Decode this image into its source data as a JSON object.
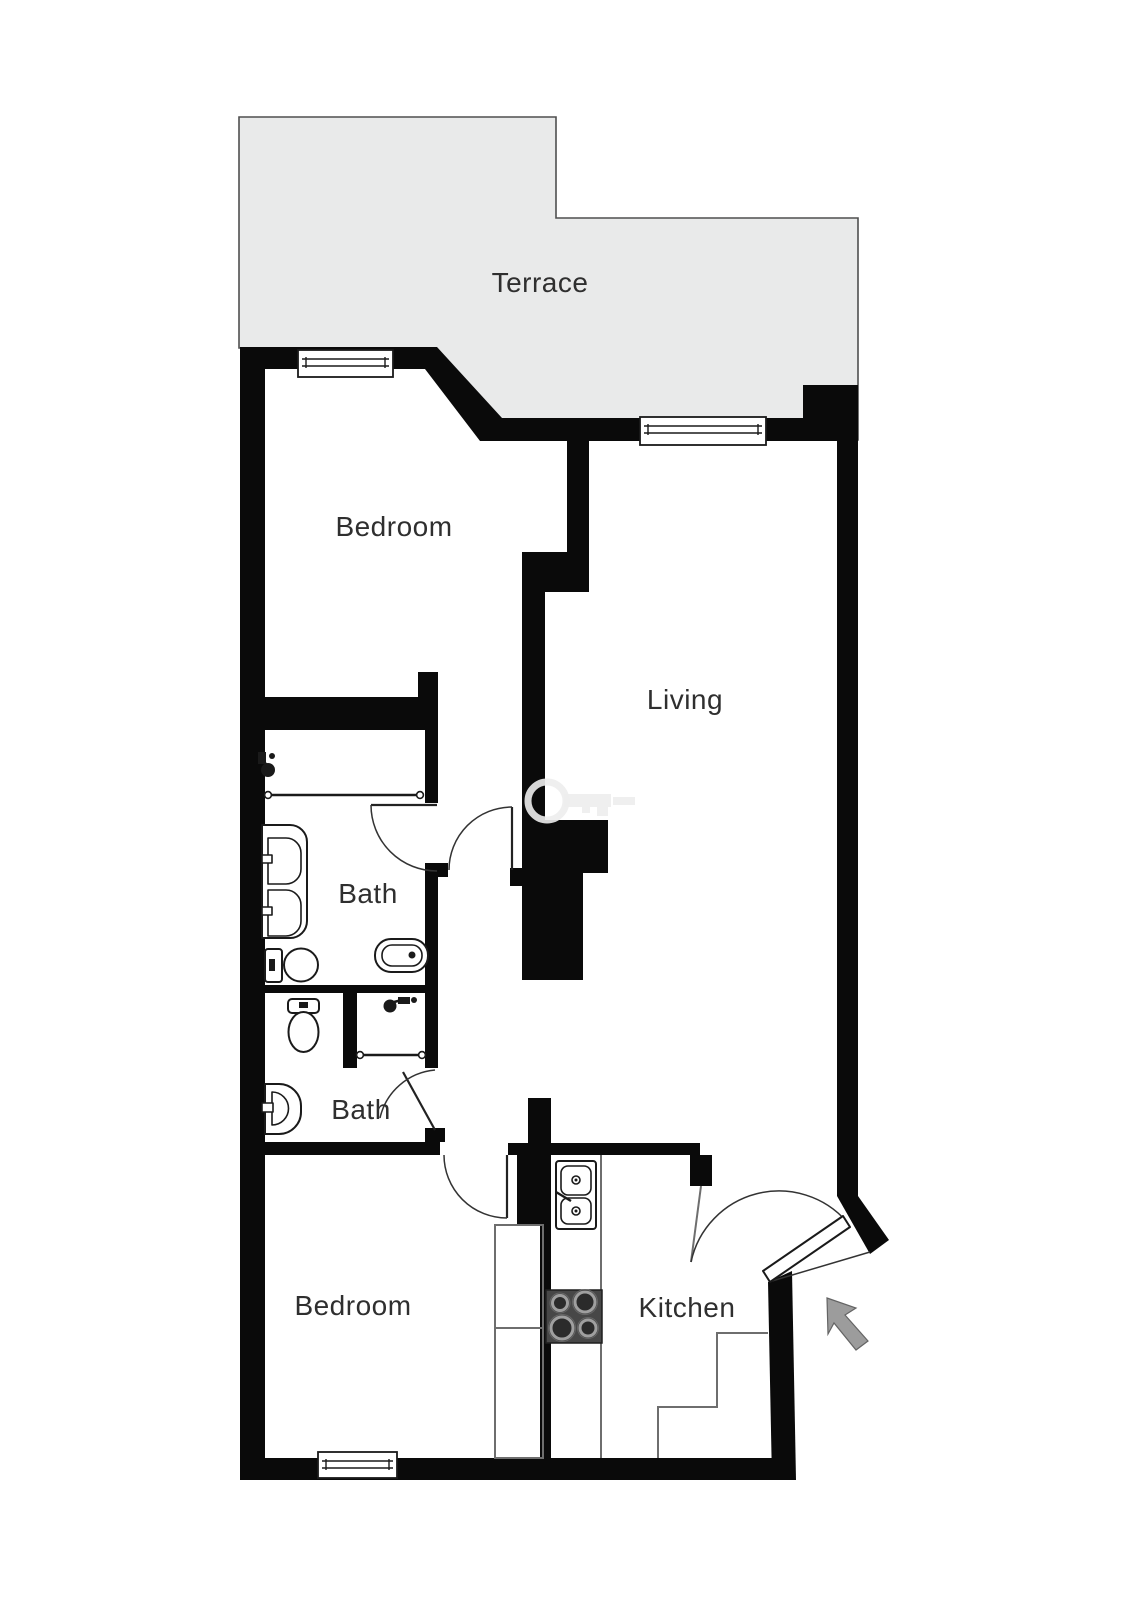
{
  "rooms": [
    {
      "name": "terrace",
      "label": "Terrace"
    },
    {
      "name": "bedroom-1",
      "label": "Bedroom"
    },
    {
      "name": "living",
      "label": "Living"
    },
    {
      "name": "bath-1",
      "label": "Bath"
    },
    {
      "name": "bath-2",
      "label": "Bath"
    },
    {
      "name": "bedroom-2",
      "label": "Bedroom"
    },
    {
      "name": "kitchen",
      "label": "Kitchen"
    }
  ],
  "colors": {
    "wall": "#0a0a0a",
    "terrace": "#e9eaea",
    "line": "#6e6e6e",
    "label": "#2f2f2f",
    "stove": "#474747",
    "arrow": "#9c9c9c",
    "watermark": "#ededed"
  },
  "icons": [
    "window",
    "door-swing",
    "shower-head",
    "shower-glass",
    "toilet",
    "bidet",
    "double-vanity",
    "hand-basin",
    "kitchen-sink",
    "stove",
    "wardrobe",
    "stairs",
    "entrance-arrow",
    "watermark-key"
  ]
}
